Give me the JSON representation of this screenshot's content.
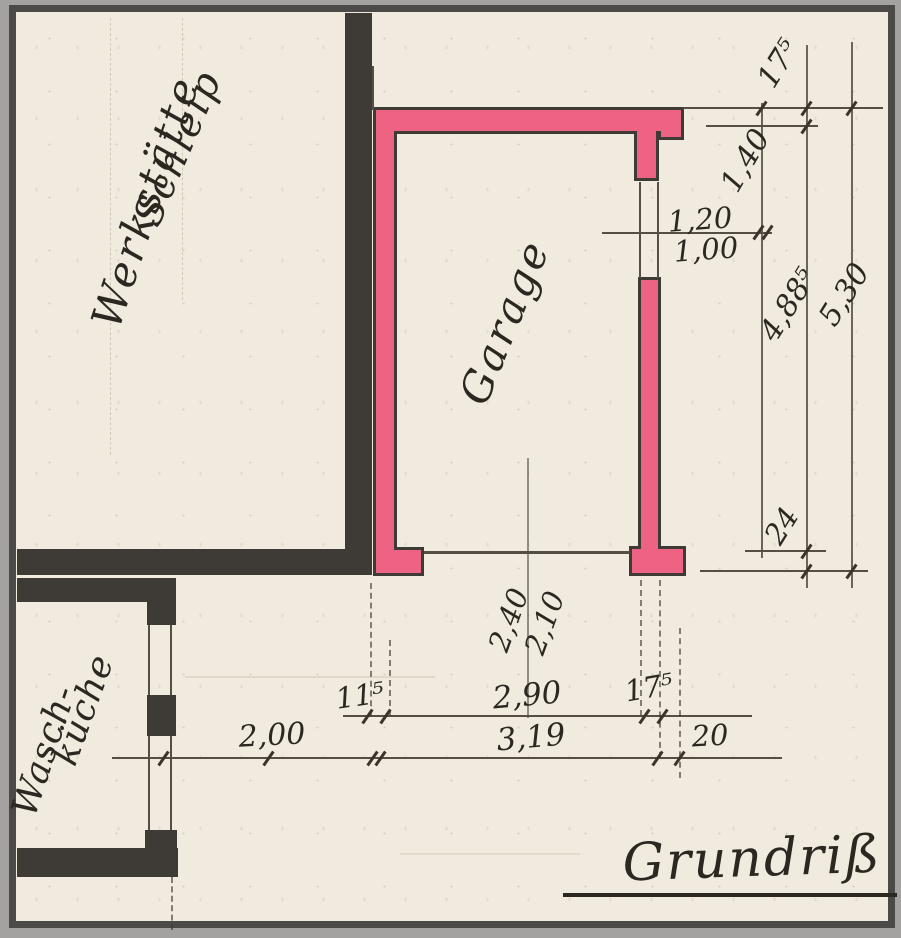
{
  "title": {
    "text": "Grundriß"
  },
  "rooms": {
    "workshop_line1": "Werkstätte",
    "workshop_line2": "Schleip",
    "garage": "Garage",
    "laundry_line1": "Wasch-",
    "laundry_line2": "küche"
  },
  "dims": {
    "wall_thickness_top": "17⁵",
    "pier_depth": "1,40",
    "window_width_outer": "1,20",
    "window_width_inner": "1,00",
    "interior_depth": "4,88⁵",
    "total_depth": "5,30",
    "rear_wall": "24",
    "door_clear_a": "2,40",
    "door_clear_b": "2,10",
    "wall_thickness_left": "11⁵",
    "door_width": "2,90",
    "wall_thickness_right": "17⁵",
    "offset_left": "2,00",
    "total_width": "3,19",
    "offset_right": "20"
  },
  "colors": {
    "paper": "#f1ebdf",
    "wall_fill": "#ee6383",
    "wall_dark": "#3e3a35",
    "ink": "#2c2721",
    "pencil": "#544e45",
    "frame": "#4b4a48",
    "mat": "#a3a2a0"
  }
}
